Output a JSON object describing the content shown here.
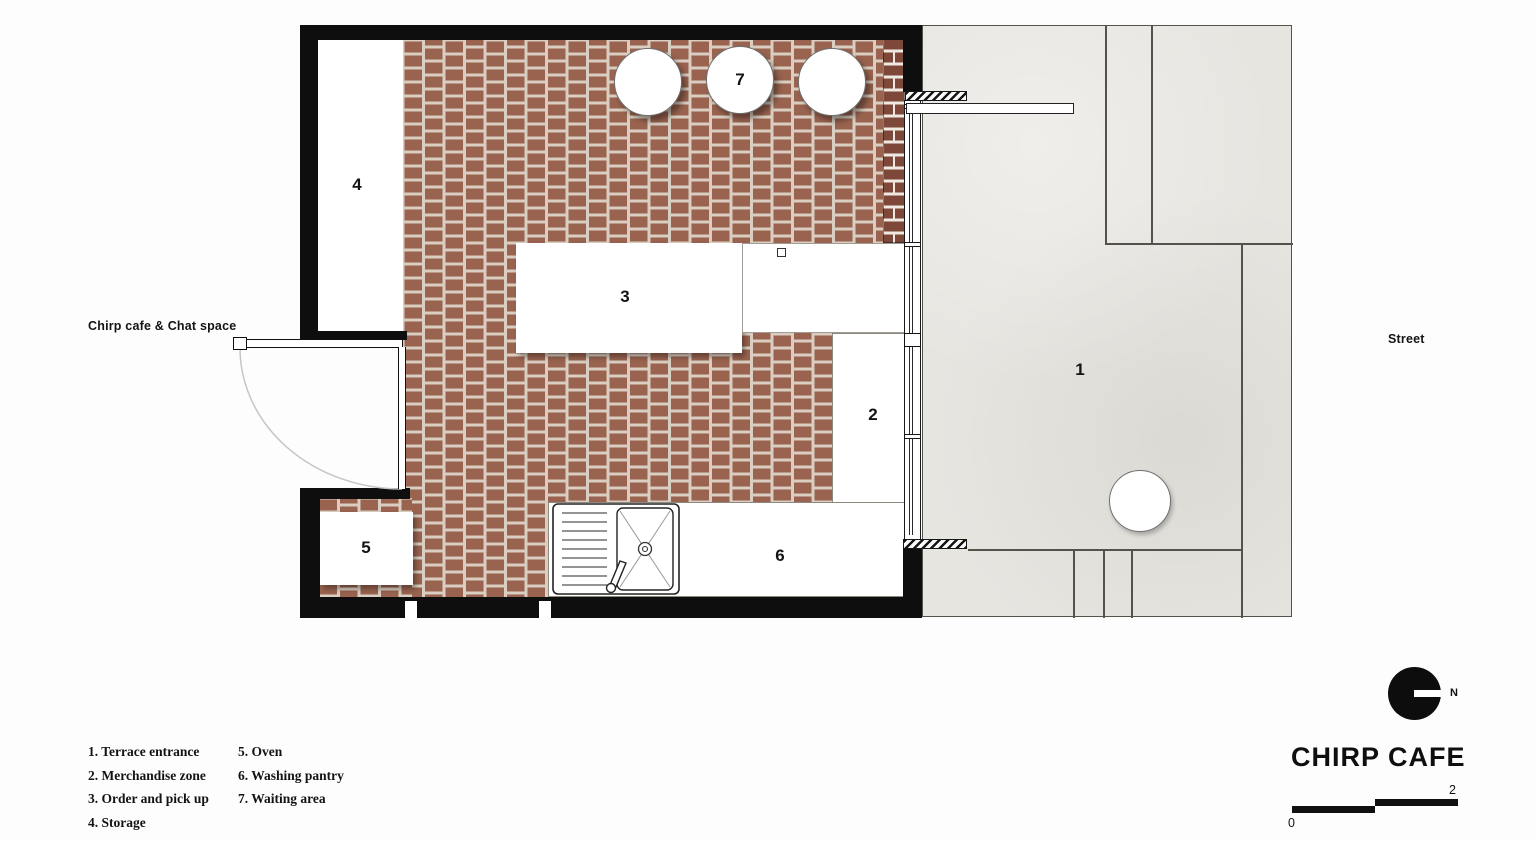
{
  "plan": {
    "room_numbers": {
      "terrace": "1",
      "merchandise": "2",
      "order": "3",
      "storage": "4",
      "oven": "5",
      "washing": "6",
      "waiting": "7"
    },
    "annotations": {
      "left_label": "Chirp cafe & Chat space",
      "street_label": "Street"
    }
  },
  "legend": {
    "column1": [
      "1. Terrace entrance",
      "2. Merchandise zone",
      "3. Order and pick up",
      "4. Storage"
    ],
    "column2": [
      "5. Oven",
      "6. Washing pantry",
      "7. Waiting area"
    ]
  },
  "title_block": {
    "brand": "CHIRP CAFE",
    "north_label": "N",
    "scale_min": "0",
    "scale_max": "2"
  },
  "colors": {
    "floor_brick": "#99634f",
    "floor_mortar": "#d9cec1",
    "wall_black": "#0e0e0e",
    "wall_brick": "#7d4739",
    "terrace_concrete": "#e7e5e0"
  }
}
